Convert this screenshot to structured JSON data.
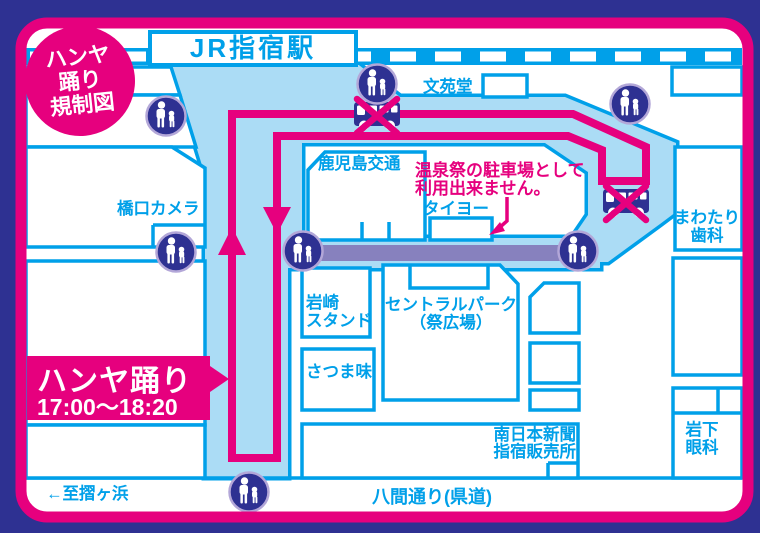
{
  "title_badge": {
    "line1": "ハンヤ",
    "line2": "踊り",
    "line3": "規制図"
  },
  "station": {
    "label": "JR指宿駅"
  },
  "event_banner": {
    "title": "ハンヤ踊り",
    "time": "17:00〜18:20"
  },
  "warning_note": {
    "line1": "温泉祭の駐車場として",
    "line2": "利用出来ません。"
  },
  "places": {
    "bunendo": "文苑堂",
    "kagoshima_kotsu": "鹿児島交通",
    "hashiguchi_camera": "橋口カメラ",
    "taiyo": "タイヨー",
    "mawatari_line1": "まわたり",
    "mawatari_line2": "歯科",
    "iwasaki_line1": "岩崎",
    "iwasaki_line2": "スタンド",
    "central_park_line1": "セントラルパーク",
    "central_park_line2": "（祭広場）",
    "satsuma_aji": "さつま味",
    "minami_nihon_line1": "南日本新聞",
    "minami_nihon_line2": "指宿販売所",
    "iwashita_line1": "岩下",
    "iwashita_line2": "眼科"
  },
  "roads": {
    "hakkendori": "八間通り(県道)",
    "to_surigahama": "←至摺ヶ浜"
  },
  "icons": {
    "pedestrian": "pedestrian-with-child-icon",
    "bus_closed": "bus-no-entry-icon"
  },
  "colors": {
    "frame_pink": "#E6007E",
    "line_blue": "#00A0E9",
    "road_fill_blue": "#ABDCF5",
    "navy": "#2E3192",
    "route_bar_purple": "#8781BE",
    "icon_ring": "#B3A7D8"
  }
}
